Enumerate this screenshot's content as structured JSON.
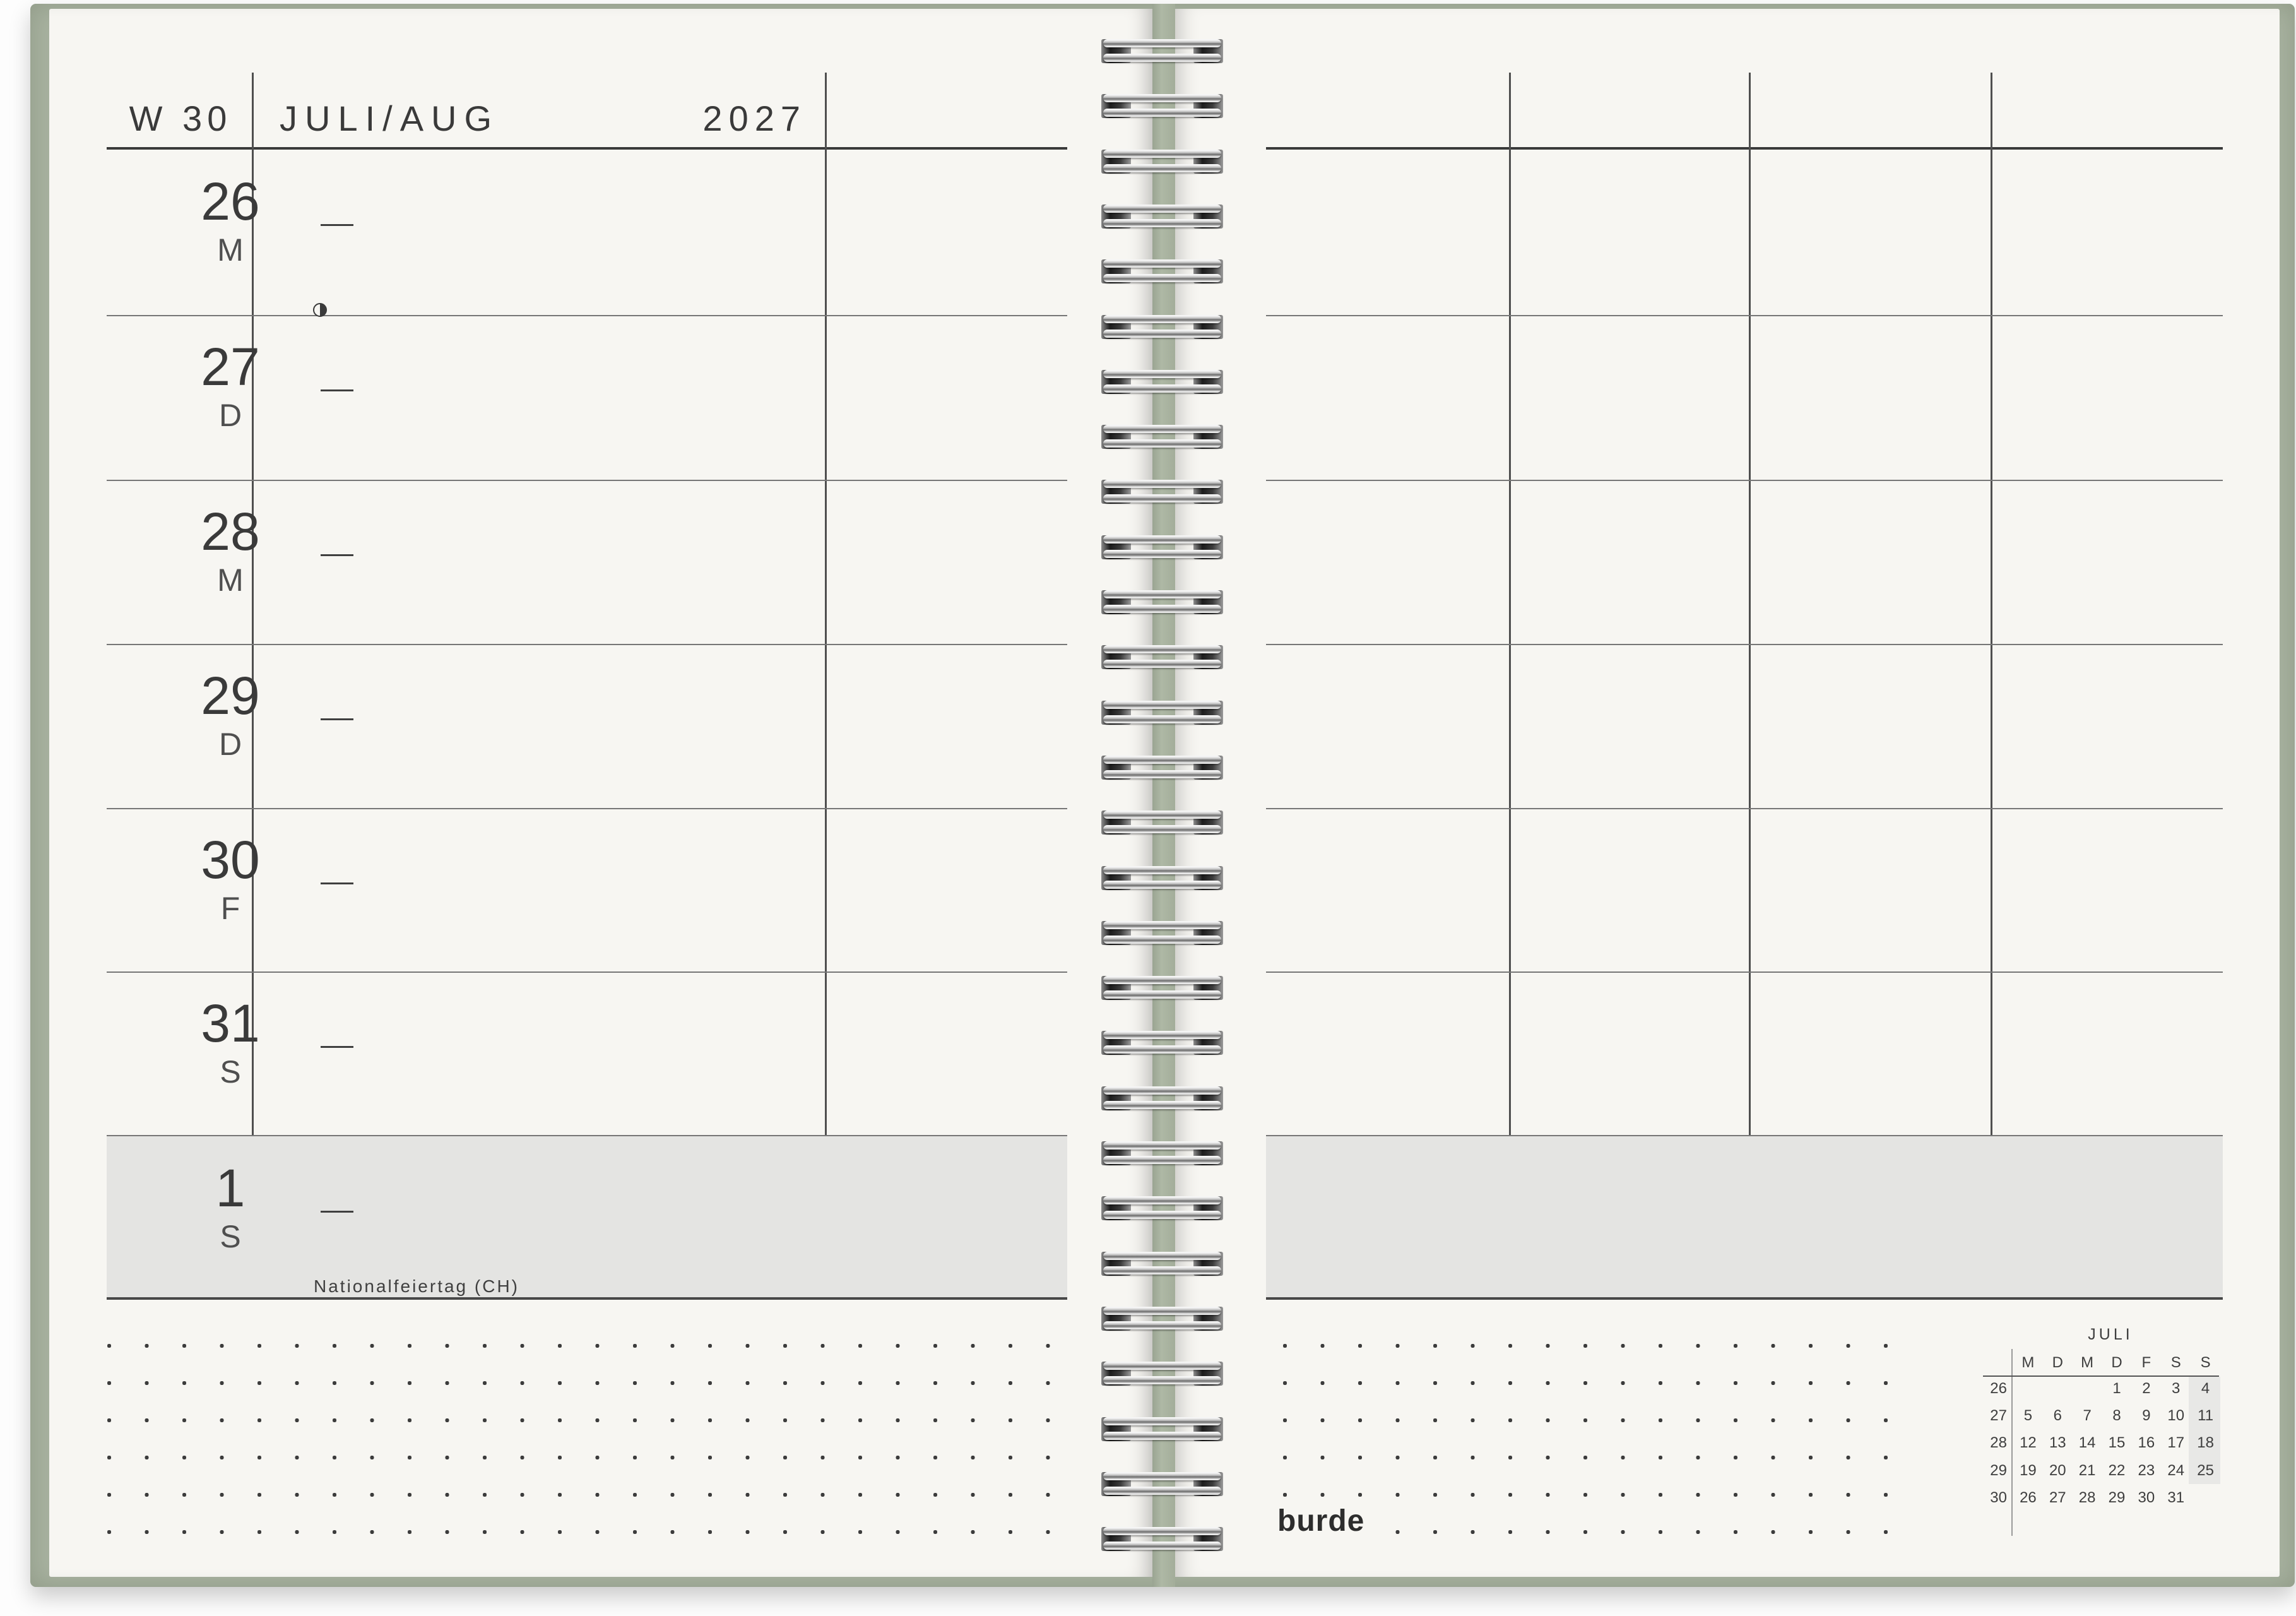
{
  "planner": {
    "header": {
      "week_label": "W 30",
      "month_label": "JULI/AUG",
      "year": "2027"
    },
    "days": [
      {
        "date": "26",
        "weekday": "M"
      },
      {
        "date": "27",
        "weekday": "D"
      },
      {
        "date": "28",
        "weekday": "M"
      },
      {
        "date": "29",
        "weekday": "D"
      },
      {
        "date": "30",
        "weekday": "F"
      },
      {
        "date": "31",
        "weekday": "S"
      },
      {
        "date": "1",
        "weekday": "S",
        "holiday": "Nationalfeiertag (CH)"
      }
    ],
    "moon_phase": "last-quarter"
  },
  "brand": {
    "logo": "burde"
  },
  "mini_calendar": {
    "title": "JULI",
    "day_headers": [
      "M",
      "D",
      "M",
      "D",
      "F",
      "S",
      "S"
    ],
    "weeks": [
      {
        "week": "26",
        "days": [
          "",
          "",
          "",
          "1",
          "2",
          "3",
          "4"
        ]
      },
      {
        "week": "27",
        "days": [
          "5",
          "6",
          "7",
          "8",
          "9",
          "10",
          "11"
        ]
      },
      {
        "week": "28",
        "days": [
          "12",
          "13",
          "14",
          "15",
          "16",
          "17",
          "18"
        ]
      },
      {
        "week": "29",
        "days": [
          "19",
          "20",
          "21",
          "22",
          "23",
          "24",
          "25"
        ]
      },
      {
        "week": "30",
        "days": [
          "26",
          "27",
          "28",
          "29",
          "30",
          "31",
          ""
        ]
      }
    ]
  },
  "colors": {
    "paper": "#f7f6f2",
    "cover_green": "#a8b2a0",
    "shaded_row": "#e4e4e2",
    "line_dark": "#3a3a3a",
    "text": "#3e3e3e"
  }
}
